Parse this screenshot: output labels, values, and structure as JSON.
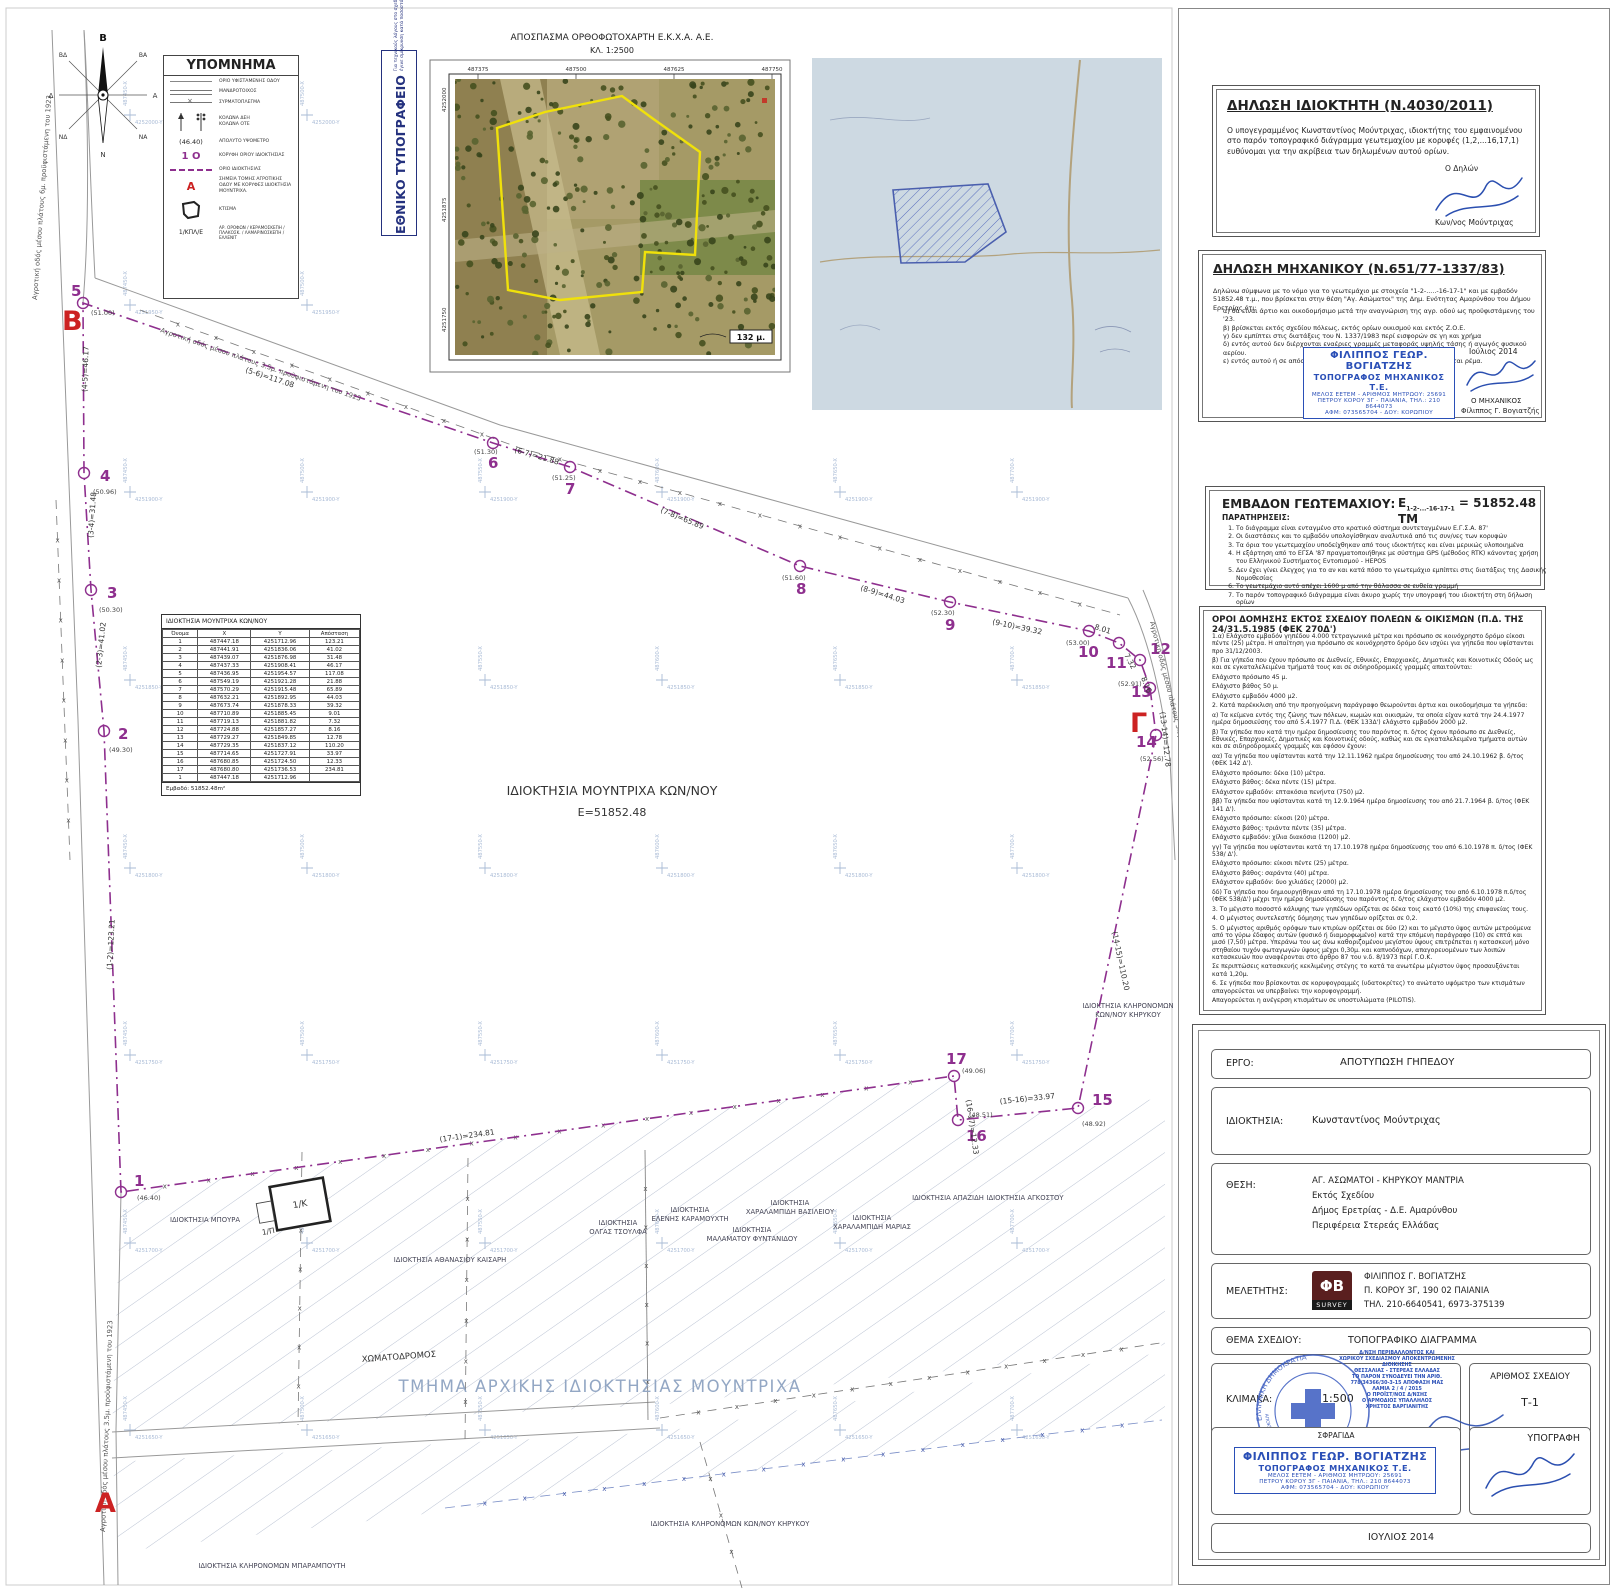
{
  "compass": {
    "n": "Β",
    "s": "Ν",
    "e": "Α",
    "w": "Δ",
    "ne": "ΒΑ",
    "nw": "ΒΔ",
    "se": "ΝΑ",
    "sw": "ΝΔ"
  },
  "legend": {
    "title": "ΥΠΟΜΝΗΜΑ",
    "items": [
      {
        "label": "ΟΡΙΟ ΥΦΙΣΤΑΜΕΝΗΣ ΟΔΟΥ"
      },
      {
        "label": "ΜΑΝΔΡΟΤΟΙΧΟΣ"
      },
      {
        "label": "ΣΥΡΜΑΤΟΠΛΕΓΜΑ"
      },
      {
        "label": "ΚΟΛΩΝΑ ΔΕΗ",
        "label2": "ΚΟΛΩΝΑ ΟΤΕ"
      },
      {
        "sample": "(46.40)",
        "label": "ΑΠΟΛΥΤΟ ΥΨΟΜΕΤΡΟ"
      },
      {
        "sample": "1 Ο",
        "label": "ΚΟΡΥΦΗ ΟΡΙΟΥ ΙΔΙΟΚΤΗΣΙΑΣ"
      },
      {
        "label": "ΟΡΙΟ ΙΔΙΟΚΤΗΣΙΑΣ"
      },
      {
        "sample": "Α",
        "label": "ΣΗΜΕΙΑ ΤΟΜΗΣ ΑΓΡΟΤΙΚΗΣ ΟΔΟΥ ΜΕ ΚΟΡΥΦΕΣ ΙΔΙΟΚΤΗΣΙΑ ΜΟΥΝΤΡΙΧΑ."
      },
      {
        "label": "ΚΤΙΣΜΑ"
      },
      {
        "sample": "1/ΚΠΛ/Ε",
        "label": "ΑΡ. ΟΡΟΦΩΝ / ΚΕΡΑΜΟΣΚΕΠΗ / ΠΛΑΚΟΣΚ. / ΛΑΜΑΡΙΝΟΣΚΕΠΗ / ΕΛΛΕΝΙΤ"
      }
    ]
  },
  "shrink_note": {
    "title": "ΕΘΝΙΚΟ ΤΥΠΟΓΡΑΦΕΙΟ",
    "line1": "Για τεχνικούς λόγους στο σχεδιάγραμμα,",
    "line2": "έγινε σμίκρυνση κατά ποσοστό",
    "pct": "39%"
  },
  "orthophoto": {
    "title": "ΑΠΟΣΠΑΣΜΑ ΟΡΘΟΦΩΤΟΧΑΡΤΗ Ε.Κ.Χ.Α. Α.Ε.",
    "scale": "ΚΛ. 1:2500",
    "x_ticks": [
      "487375",
      "487500",
      "487625",
      "487750"
    ],
    "y_ticks": [
      "4252000",
      "4251875",
      "4251750"
    ],
    "scalebar": "132 μ."
  },
  "drawing": {
    "parcel_label": "ΙΔΙΟΚΤΗΣΙΑ ΜΟΥΝΤΡΙΧΑ ΚΩΝ/ΝΟΥ",
    "parcel_area": "Ε=51852.48",
    "section_points": {
      "A": "A",
      "B": "B",
      "G": "Γ"
    },
    "building_code": "1/Κ",
    "building_porch": "1/Π",
    "vertices": [
      {
        "n": "1",
        "e": "(46.40)"
      },
      {
        "n": "2",
        "e": "(49.30)"
      },
      {
        "n": "3",
        "e": "(50.30)"
      },
      {
        "n": "4",
        "e": "(50.96)"
      },
      {
        "n": "5",
        "e": "(51.00)"
      },
      {
        "n": "6",
        "e": "(51.30)"
      },
      {
        "n": "7",
        "e": "(51.25)"
      },
      {
        "n": "8",
        "e": "(51.60)"
      },
      {
        "n": "9",
        "e": "(52.30)"
      },
      {
        "n": "10",
        "e": "(53.00)"
      },
      {
        "n": "11",
        "e": ""
      },
      {
        "n": "12",
        "e": "(52.91)"
      },
      {
        "n": "13",
        "e": ""
      },
      {
        "n": "14",
        "e": "(52.56)"
      },
      {
        "n": "15",
        "e": "(48.92)"
      },
      {
        "n": "16",
        "e": "(48.51)"
      },
      {
        "n": "17",
        "e": "(49.06)"
      }
    ],
    "distance_labels": [
      "(1-2)=123.21",
      "(2-3)=41.02",
      "(3-4)=31.48",
      "(4-5)=46.17",
      "(5-6)=117.08",
      "(6-7)=21.88",
      "(7-8)=65.89",
      "(8-9)=44.03",
      "(9-10)=39.32",
      "8.01",
      "7.32",
      "8.16",
      "(13-14)=12.78",
      "(14-15)=110.20",
      "(15-16)=33.97",
      "(16-17)=12.33",
      "(17-1)=234.81"
    ],
    "road_labels": [
      "Αγροτική οδός μέσου πλάτους 6μ. προϋφιστάμενη του 1923",
      "Αγροτική οδός μέσου πλάτους 3.5μ. προϋφιστάμενη του 1923",
      "Αγροτική οδός μέσου πλάτους 3.5μ. προϋφιστάμενη του '23",
      "Αγροτική οδός μέσου πλάτους 3.5μ. προϋφιστάμενη του 1923"
    ],
    "neighbor_labels": [
      [
        "ΙΔΙΟΚΤΗΣΙΑ ΜΠΟΥΡΑ"
      ],
      [
        "ΙΔΙΟΚΤΗΣΙΑ ΑΘΑΝΑΣΙΟΥ ΚΑΙΣΑΡΗ"
      ],
      [
        "ΙΔΙΟΚΤΗΣΙΑ",
        "ΟΛΓΑΣ ΤΣΟΥΛΦΑ"
      ],
      [
        "ΙΔΙΟΚΤΗΣΙΑ",
        "ΕΛΕΝΗΣ ΚΑΡΑΜΟΥΧΤΗ"
      ],
      [
        "ΙΔΙΟΚΤΗΣΙΑ",
        "ΜΑΛΑΜΑΤΟΥ ΦΥΝΤΑΝΙΔΟΥ"
      ],
      [
        "ΙΔΙΟΚΤΗΣΙΑ",
        "ΧΑΡΑΛΑΜΠΙΔΗ ΒΑΣΙΛΕΙΟΥ"
      ],
      [
        "ΙΔΙΟΚΤΗΣΙΑ",
        "ΧΑΡΑΛΑΜΠΙΔΗ ΜΑΡΙΑΣ"
      ],
      [
        "ΙΔΙΟΚΤΗΣΙΑ ΑΠΑΖΙΔΗ"
      ],
      [
        "ΙΔΙΟΚΤΗΣΙΑ ΑΓΚΟΣΤΟΥ"
      ],
      [
        "ΙΔΙΟΚΤΗΣΙΑ ΚΛΗΡΟΝΟΜΩΝ",
        "ΚΩΝ/ΝΟΥ ΚΗΡΥΚΟΥ"
      ],
      [
        "ΙΔΙΟΚΤΗΣΙΑ ΚΛΗΡΟΝΟΜΩΝ ΚΩΝ/ΝΟΥ ΚΗΡΥΚΟΥ"
      ],
      [
        "ΙΔΙΟΚΤΗΣΙΑ ΚΛΗΡΟΝΟΜΩΝ ΜΠΑΡΑΜΠΟΥΤΗ"
      ]
    ],
    "area_labels": {
      "dirt_road": "ΧΩΜΑΤΟΔΡΟΜΟΣ",
      "original_property": "ΤΜΗΜΑ ΑΡΧΙΚΗΣ ΙΔΙΟΚΤΗΣΙΑΣ ΜΟΥΝΤΡΙΧΑ"
    },
    "grid": {
      "x_labels": [
        "487450-X",
        "487500-X",
        "487550-X",
        "487600-X",
        "487650-X",
        "487700-X"
      ],
      "y_labels": [
        "4252000-Y",
        "4251950-Y",
        "4251900-Y",
        "4251850-Y",
        "4251800-Y",
        "4251750-Y",
        "4251700-Y",
        "4251650-Y"
      ]
    }
  },
  "coord_table": {
    "title": "ΙΔΙΟΚΤΗΣΙΑ ΜΟΥΝΤΡΙΧΑ ΚΩΝ/ΝΟΥ",
    "headers": [
      "Όνομα",
      "X",
      "Y",
      "Απόσταση"
    ],
    "rows": [
      [
        "1",
        "487447.18",
        "4251712.96",
        "123.21"
      ],
      [
        "2",
        "487441.91",
        "4251836.06",
        "41.02"
      ],
      [
        "3",
        "487439.07",
        "4251876.98",
        "31.48"
      ],
      [
        "4",
        "487437.33",
        "4251908.41",
        "46.17"
      ],
      [
        "5",
        "487436.95",
        "4251954.57",
        "117.08"
      ],
      [
        "6",
        "487549.19",
        "4251921.28",
        "21.88"
      ],
      [
        "7",
        "487570.29",
        "4251915.48",
        "65.89"
      ],
      [
        "8",
        "487632.21",
        "4251892.95",
        "44.03"
      ],
      [
        "9",
        "487673.74",
        "4251878.33",
        "39.32"
      ],
      [
        "10",
        "487710.89",
        "4251885.45",
        "9.01"
      ],
      [
        "11",
        "487719.13",
        "4251881.82",
        "7.32"
      ],
      [
        "12",
        "487724.88",
        "4251857.27",
        "8.16"
      ],
      [
        "13",
        "487729.27",
        "4251849.85",
        "12.78"
      ],
      [
        "14",
        "487729.35",
        "4251837.12",
        "110.20"
      ],
      [
        "15",
        "487714.65",
        "4251727.91",
        "33.97"
      ],
      [
        "16",
        "487680.85",
        "4251724.50",
        "12.33"
      ],
      [
        "17",
        "487680.80",
        "4251736.53",
        "234.81"
      ],
      [
        "1",
        "487447.18",
        "4251712.96",
        ""
      ]
    ],
    "footer": "Εμβαδό: 51852.48m²"
  },
  "owner_declaration": {
    "title": "ΔΗΛΩΣΗ ΙΔΙΟΚΤΗΤΗ (Ν.4030/2011)",
    "body": "Ο υπογεγραμμένος Κωνσταντίνος Μούντριχας,  ιδιοκτήτης του εμφαινομένου στο παρόν τοπογραφικό διάγραμμα γεωτεμαχίου με κορυφές (1,2,...16,17,1) ευθύνομαι για την ακρίβεια των δηλωμένων αυτού ορίων.",
    "signer_label": "Ο Δηλών",
    "signer_name": "Κων/νος Μούντριχας"
  },
  "engineer_declaration": {
    "title": "ΔΗΛΩΣΗ ΜΗΧΑΝΙΚΟΥ (Ν.651/77-1337/83)",
    "intro": "Δηλώνω σύμφωνα με το νόμο για το γεωτεμάχιο με στοιχεία \"1-2-.....-16-17-1\" και με εμβαδόν 51852.48 τ.μ., που βρίσκεται στην θέση \"Αγ. Ασώματοι\" της Δημ. Ενότητας Αμαρύνθου του Δήμου Ερετρίας ότι:",
    "items": [
      "α) θα είναι άρτιο και οικοδομήσιμο μετά την αναγνώριση της αγρ. οδού ως προϋφιστάμενης του '23.",
      "β) βρίσκεται εκτός σχεδίου πόλεως, εκτός ορίων οικισμού και εκτός Ζ.Ο.Ε.",
      "γ) δεν εμπίπτει στις διατάξεις του Ν. 1337/1983 περί εισφορών σε γη και χρήμα",
      "δ) εντός αυτού δεν διέρχονται εναέριες γραμμές μεταφοράς υψηλής τάσης ή αγωγός φυσικού αερίου.",
      "ε) εντός αυτού ή σε απόσταση μικρότερη των 20μ απο αυτό δεν διέρχεται ρέμα."
    ],
    "date": "Ιούλιος 2014",
    "signer_label": "Ο ΜΗΧΑΝΙΚΟΣ",
    "signer_name": "Φίλιππος Γ. Βογιατζής"
  },
  "engineer_stamp": {
    "l1": "ΦΙΛΙΠΠΟΣ ΓΕΩΡ. ΒΟΓΙΑΤΖΗΣ",
    "l2": "ΤΟΠΟΓΡΑΦΟΣ ΜΗΧΑΝΙΚΟΣ Τ.Ε.",
    "l3": "ΜΕΛΟΣ ΕΕΤΕΜ - ΑΡΙΘΜΟΣ ΜΗΤΡΩΟΥ: 25691",
    "l4": "ΠΕΤΡΟΥ ΚΟΡΟΥ 3Γ - ΠΑΙΑΝΙΑ, ΤΗΛ.: 210 8644073",
    "l5": "ΑΦΜ: 073565704 - ΔΟΥ: ΚΟΡΩΠΙΟΥ"
  },
  "area_section": {
    "title": "ΕΜΒΑΔΟΝ ΓΕΩΤΕΜΑΧΙΟΥ:",
    "formula_prefix": "Ε",
    "formula_sub": "1-2-...-16-17-1",
    "formula_value": "= 51852.48 ΤΜ",
    "notes_title": "ΠΑΡΑΤΗΡΗΣΕΙΣ:",
    "notes": [
      "Το διάγραμμα είναι ενταγμένο στο κρατικό σύστημα συντεταγμένων Ε.Γ.Σ.Α. 87'",
      "Οι διαστάσεις και το εμβαδόν υπολογίσθηκαν αναλυτικά από τις συν/νες των κορυφών",
      "Τα όρια του γεωτεμαχίου υποδείχθηκαν από τους ιδιοκτήτες και είναι μερικώς υλοποιημένα",
      "Η εξάρτηση από το ΕΓΣΑ '87 πραγματοποιήθηκε με σύστημα GPS (μέθοδος RTK) κάνοντας χρήση του Ελληνικού Συστήματος Εντοπισμού - HEPOS",
      "Δεν έχει γίνει έλεγχος για το αν και κατά πόσο το γεωτεμάχιο εμπίπτει στις διατάξεις της Δασικής Νομοθεσίας",
      "Το γεωτεμάχιο αυτό απέχει 1600 μ από την θάλασσα σε ευθεία γραμμή",
      "Το παρόν τοπογραφικό διάγραμμα είναι άκυρο χωρίς την υπογραφή του ιδιοκτήτη στη δήλωση ορίων"
    ]
  },
  "building_terms": {
    "title": "ΟΡΟΙ ΔΟΜΗΣΗΣ ΕΚΤΟΣ ΣΧΕΔΙΟΥ ΠΟΛΕΩΝ & ΟΙΚΙΣΜΩΝ (Π.Δ. ΤΗΣ 24/31.5.1985 (ΦΕΚ 270Δ')",
    "paragraphs": [
      "1.α) Ελάχιστο εμβαδόν γηπέδου 4.000 τετραγωνικά μέτρα και πρόσωπο σε κοινόχρηστο δρόμο είκοσι πέντε (25) μέτρα. Η απαίτηση για πρόσωπο σε κοινόχρηστο δρόμο  δεν ισχύει για γήπεδα που υφίστανται προ 31/12/2003.",
      "β) Για γήπεδα που έχουν πρόσωπο σε Διεθνείς, Εθνικές, Επαρχιακές, Δημοτικές και Κοινοτικές Οδούς ως και σε εγκαταλελειμένα τμήματά τους και σε σιδηροδρομικές γραμμές απαιτούνται:",
      "Ελάχιστο πρόσωπο 45 μ.",
      "Ελάχιστο βάθος 50 μ.",
      "Ελάχιστο εμβαδόν 4000 μ2.",
      "2. Κατά παρέκκλιση από την προηγούμενη παράγραφο θεωρούνται άρτια και οικοδομήσιμα τα γήπεδα:",
      "α) Τα κείμενα εντός της ζώνης των πόλεων, κωμών και οικισμών, τα οποία είχαν κατά την 24.4.1977 ημέρα δημοσιεύσης του από 5.4.1977 Π.Δ. (ΦΕΚ 133Δ') ελάχιστο εμβαδόν 2000 μ2.",
      "β) Τα γήπεδα που κατά την ημέρα δημοσίευσης του παρόντος π. δ/τος έχουν πρόσωπο σε Διεθνείς, Εθνικές, Επαρχιακές, Δημοτικές και Κοινοτικές οδούς, καθώς και σε εγκαταλελειμένα τμήματα αυτών και σε σιδηροδρομικές γραμμές και εφόσον έχουν:",
      "αα) Τα γήπεδα που υφίστανται κατά την 12.11.1962 ημέρα δημοσίευσης του από 24.10.1962 β. δ/τος (ΦΕΚ 142 Δ').",
      "Ελάχιστο πρόσωπο: δέκα (10) μέτρα.",
      "Ελάχιστο βάθος: δέκα πέντε (15) μέτρα.",
      "Ελάχιστον εμβαδόν: επτακόσια πενήντα (750) μ2.",
      "ββ) Τα γήπεδα που υφίστανται κατά τη 12.9.1964 ημέρα δημοσίευσης του από 21.7.1964 β. δ/τος (ΦΕΚ 141 Δ').",
      "Ελάχιστο πρόσωπο: είκοσι (20) μέτρα.",
      "Ελάχιστο βάθος: τριάντα πέντε (35) μέτρα.",
      "Ελάχιστο εμβαδόν: χίλια διακόσια (1200) μ2.",
      "γγ) Τα γήπεδα που υφίστανται κατά τη 17.10.1978 ημέρα δημοσίευσης του από 6.10.1978 π. δ/τος (ΦΕΚ 538/ Δ').",
      "Ελάχιστο πρόσωπο: είκοσι πέντε (25) μέτρα.",
      "Ελάχιστο βάθος: σαράντα (40) μέτρα.",
      "Ελάχιστον εμβαδόν: δυο χιλιάδες (2000) μ2.",
      "δδ) Τα γήπεδα που δημιουργήθηκαν από τη 17.10.1978 ημέρα δημοσίευσης του από 6.10.1978 π.δ/τος (ΦΕΚ 538/Δ') μέχρι την ημέρα δημοσίευσης του παρόντος π. δ/τος ελάχιστον εμβαδόν 4000 μ2.",
      "3. Το μέγιστο ποσοστό κάλυψης των γηπέδων ορίζεται σε δέκα τοις εκατό (10%) της επιφανείας τους.",
      "4. Ο μέγιστος συντελεστής δόμησης των γηπέδων ορίζεται σε 0,2.",
      "5. Ο μέγιστος αριθμός ορόφων των κτιρίων ορίζεται σε δύο (2) και το μέγιστο ύψος αυτών μετρούμενα από το γύρω έδαφος αυτών (φυσικό ή διαμορφωμένο) κατά την επόμενη παράγραφο (10) σε επτά και μισό (7,50) μέτρα. Υπεράνω του ως άνω καθοριζομένου μεγίστου ύψους επιτρέπεται η κατασκευή μόνο στηθαίου τυχόν φωταγωγών ύψους μέχρι 0,30μ. και καπνοδόχων, απαγορευομένων των λοιπών κατασκευών που αναφέρονται στο άρθρο 87 του ν.δ. 8/1973 περί Γ.Ο.Κ.",
      "Σε περιπτώσεις κατασκευής κεκλιμένης στέγης το κατά τα ανωτέρω μέγιστον ύψος προσαυξάνεται κατά 1,20μ.",
      "6. Σε γήπεδα που βρίσκονται σε κορυφογραμμές (υδατοκρίτες) το ανώτατο υψόμετρο των κτισμάτων απαγορεύεται να υπερβαίνει την κορυφογραμμή.",
      "Απαγορεύεται η ανέγερση κτισμάτων σε υποστυλώματα (PILOTIS)."
    ]
  },
  "title_block": {
    "ergo_label": "ΕΡΓΟ:",
    "ergo": "ΑΠΟΤΥΠΩΣΗ ΓΗΠΕΔΟΥ",
    "owner_label": "ΙΔΙΟΚΤΗΣΙΑ:",
    "owner": "Κωνσταντίνος Μούντριχας",
    "location_label": "ΘΕΣΗ:",
    "location_lines": [
      "ΑΓ. ΑΣΩΜΑΤΟΙ - ΚΗΡΥΚΟΥ ΜΑΝΤΡΙΑ",
      "Εκτός Σχεδίου",
      "Δήμος Ερετρίας - Δ.Ε. Αμαρύνθου",
      "Περιφέρεια Στερεάς Ελλάδας"
    ],
    "surveyor_label": "ΜΕΛΕΤΗΤΗΣ:",
    "surveyor_lines": [
      "ΦΙΛΙΠΠΟΣ Γ. ΒΟΓΙΑΤΖΗΣ",
      "Π. ΚΟΡΟΥ 3Γ, 190 02 ΠΑΙΑΝΙΑ",
      "ΤΗΛ. 210-6640541, 6973-375139"
    ],
    "logo_text": "ΦΒ",
    "logo_sub": "SURVEY",
    "subject_label": "ΘΕΜΑ ΣΧΕΔΙΟΥ:",
    "subject": "ΤΟΠΟΓΡΑΦΙΚΟ ΔΙΑΓΡΑΜΜΑ",
    "scale_label": "ΚΛΙΜΑΚΑ:",
    "scale": "1:500",
    "number_label": "ΑΡΙΘΜΟΣ ΣΧΕΔΙΟΥ",
    "number": "Τ-1",
    "stamp_label": "ΣΦΡΑΓΙΔΑ",
    "sign_label": "ΥΠΟΓΡΑΦΗ",
    "date": "ΙΟΥΛΙΟΣ 2014"
  },
  "approval_stamp": {
    "lines": [
      "Δ/ΝΣΗ ΠΕΡΙΒΑΛΛΟΝΤΟΣ ΚΑΙ",
      "ΧΩΡΙΚΟΥ ΣΧΕΔΙΑΣΜΟΥ ΑΠΟΚΕΝΤΡΩΜΕΝΗΣ ΔΙΟΙΚΗΣΗΣ",
      "ΘΕΣΣΑΛΙΑΣ - ΣΤΕΡΕΑΣ ΕΛΛΑΔΑΣ",
      "ΤΟ ΠΑΡΟΝ ΣΥΝΟΔΕΥΕΙ ΤΗΝ ΑΡΙΘ.",
      "778/34366/30-3-15 ΑΠΟΦΑΣΗ ΜΑΣ",
      "ΛΑΜΙΑ  2 / 4 / 2015",
      "Ο ΠΡΟΪΣΤ/ΝΟΣ Δ/ΝΣΗΣ",
      "Ο ΑΡΜΟΔΙΟΣ ΥΠΑΛΛΗΛΟΣ",
      "ΧΡΗΣΤΟΣ ΒΑΡΓΙΑΝΙΤΗΣ"
    ],
    "round_top": "ΕΛΛΗΝΙΚΗ ΔΗΜΟΚΡΑΤΙΑ",
    "round_bottom": "ΑΠΟΚΕΝΤΡΩΜΕΝΗ ΔΙΟΙΚΗΣΗ ΘΕΣΣΑΛΙΑΣ - ΣΤ. ΕΛΛΑΔΑΣ"
  },
  "colors": {
    "boundary": "#8e2f8e",
    "section_letter": "#cc2222",
    "stamp_blue": "#2a4fb7",
    "grid_blue": "#a9bbd6",
    "faded_label": "#93a7c4",
    "ortho_outline": "#f0e10a"
  }
}
